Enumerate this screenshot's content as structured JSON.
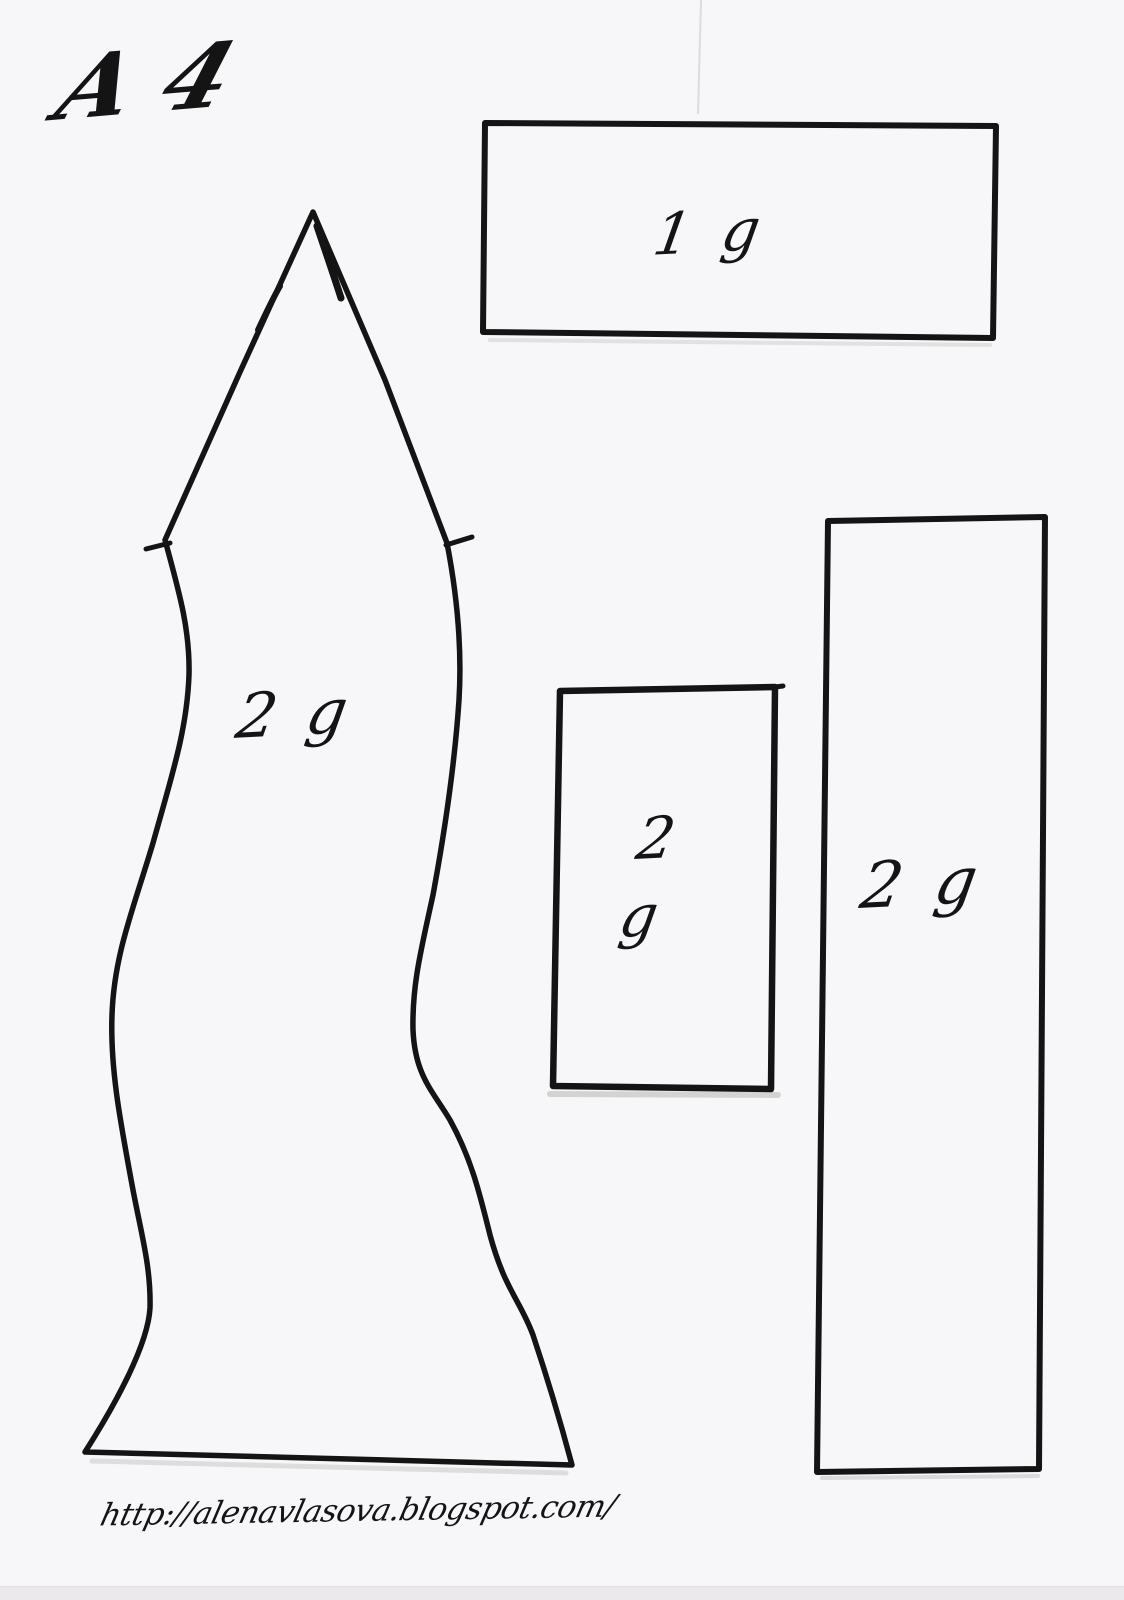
{
  "sheet": {
    "size_label": "A 4",
    "source_url": "http://alenavlasova.blogspot.com/"
  },
  "pieces": {
    "top_strip": {
      "label": "1 g"
    },
    "body": {
      "label": "2 g"
    },
    "small_rect": {
      "label_top": "2",
      "label_bottom": "g"
    },
    "tall_strip": {
      "label": "2 g"
    }
  },
  "colors": {
    "ink": "#141414",
    "paper": "#f7f6f9",
    "scan_shadow": "#b9b6b2",
    "bottom_strip": "#ebe9ec",
    "faint_line": "#dcdbe1"
  }
}
